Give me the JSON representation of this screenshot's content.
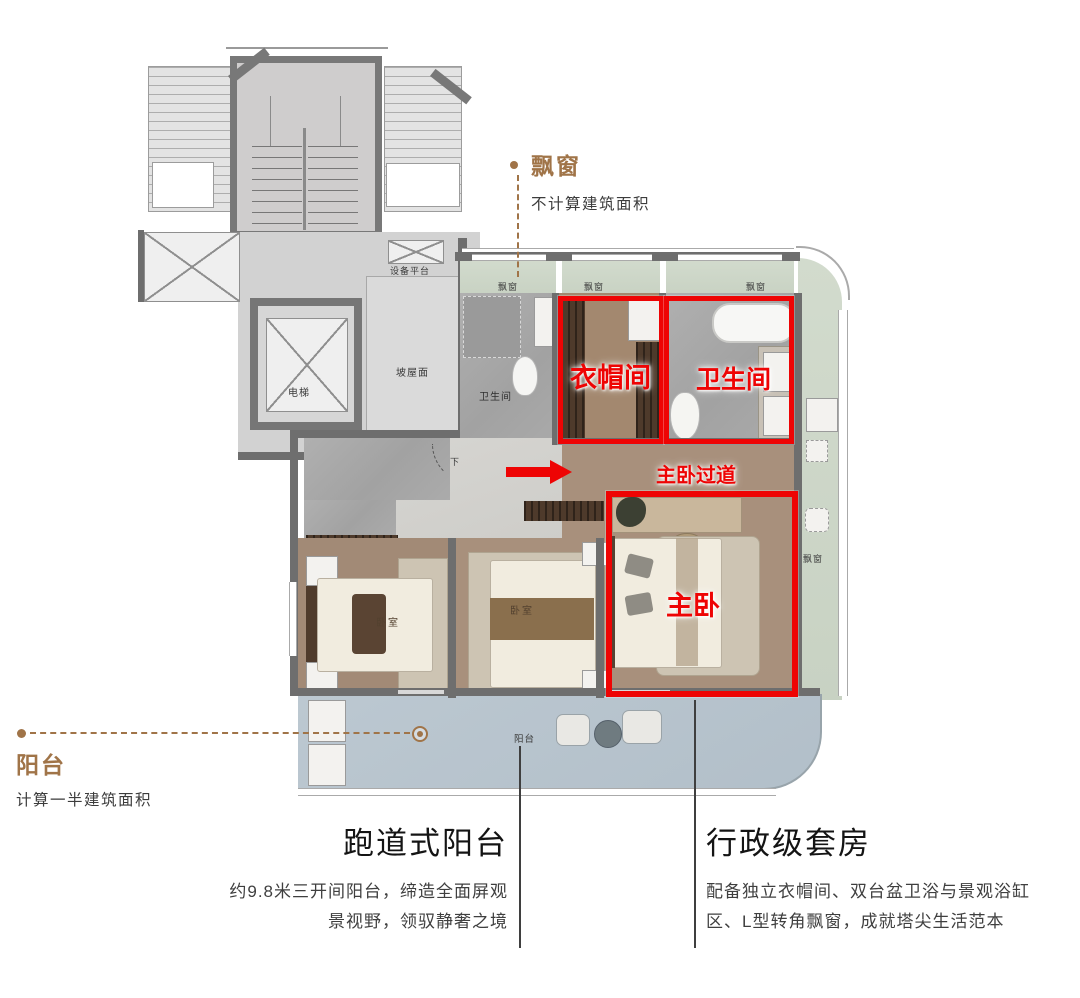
{
  "colors": {
    "annotation_red": "#EE0404",
    "accent_brown": "#A07448",
    "body_text": "#3F3F3F",
    "wall_gray": "#6E6E6E",
    "balcony_blue": "#B6C3CC",
    "bay_sage": "#CCD6C8"
  },
  "callouts": {
    "bay": {
      "label": "飘窗",
      "note": "不计算建筑面积"
    },
    "balcony": {
      "label": "阳台",
      "note": "计算一半建筑面积"
    }
  },
  "highlights": {
    "cloakroom": "衣帽间",
    "bath": "卫生间",
    "corridor": "主卧过道",
    "master": "主卧"
  },
  "plan": {
    "equipment_platform": "设备平台",
    "elevator": "电梯",
    "sloped_roof": "坡屋面",
    "stair_down": "下",
    "stair_up": "上",
    "hall_down": "下",
    "bath_small": "卫生间",
    "bay_small": "飘窗",
    "bedroom": "卧室",
    "balcony_small": "阳台"
  },
  "features": {
    "balcony": {
      "title": "跑道式阳台",
      "line1": "约9.8米三开间阳台，缔造全面屏观",
      "line2": "景视野，领驭静奢之境"
    },
    "suite": {
      "title": "行政级套房",
      "line1": "配备独立衣帽间、双台盆卫浴与景观浴缸",
      "line2": "区、L型转角飘窗，成就塔尖生活范本"
    }
  }
}
